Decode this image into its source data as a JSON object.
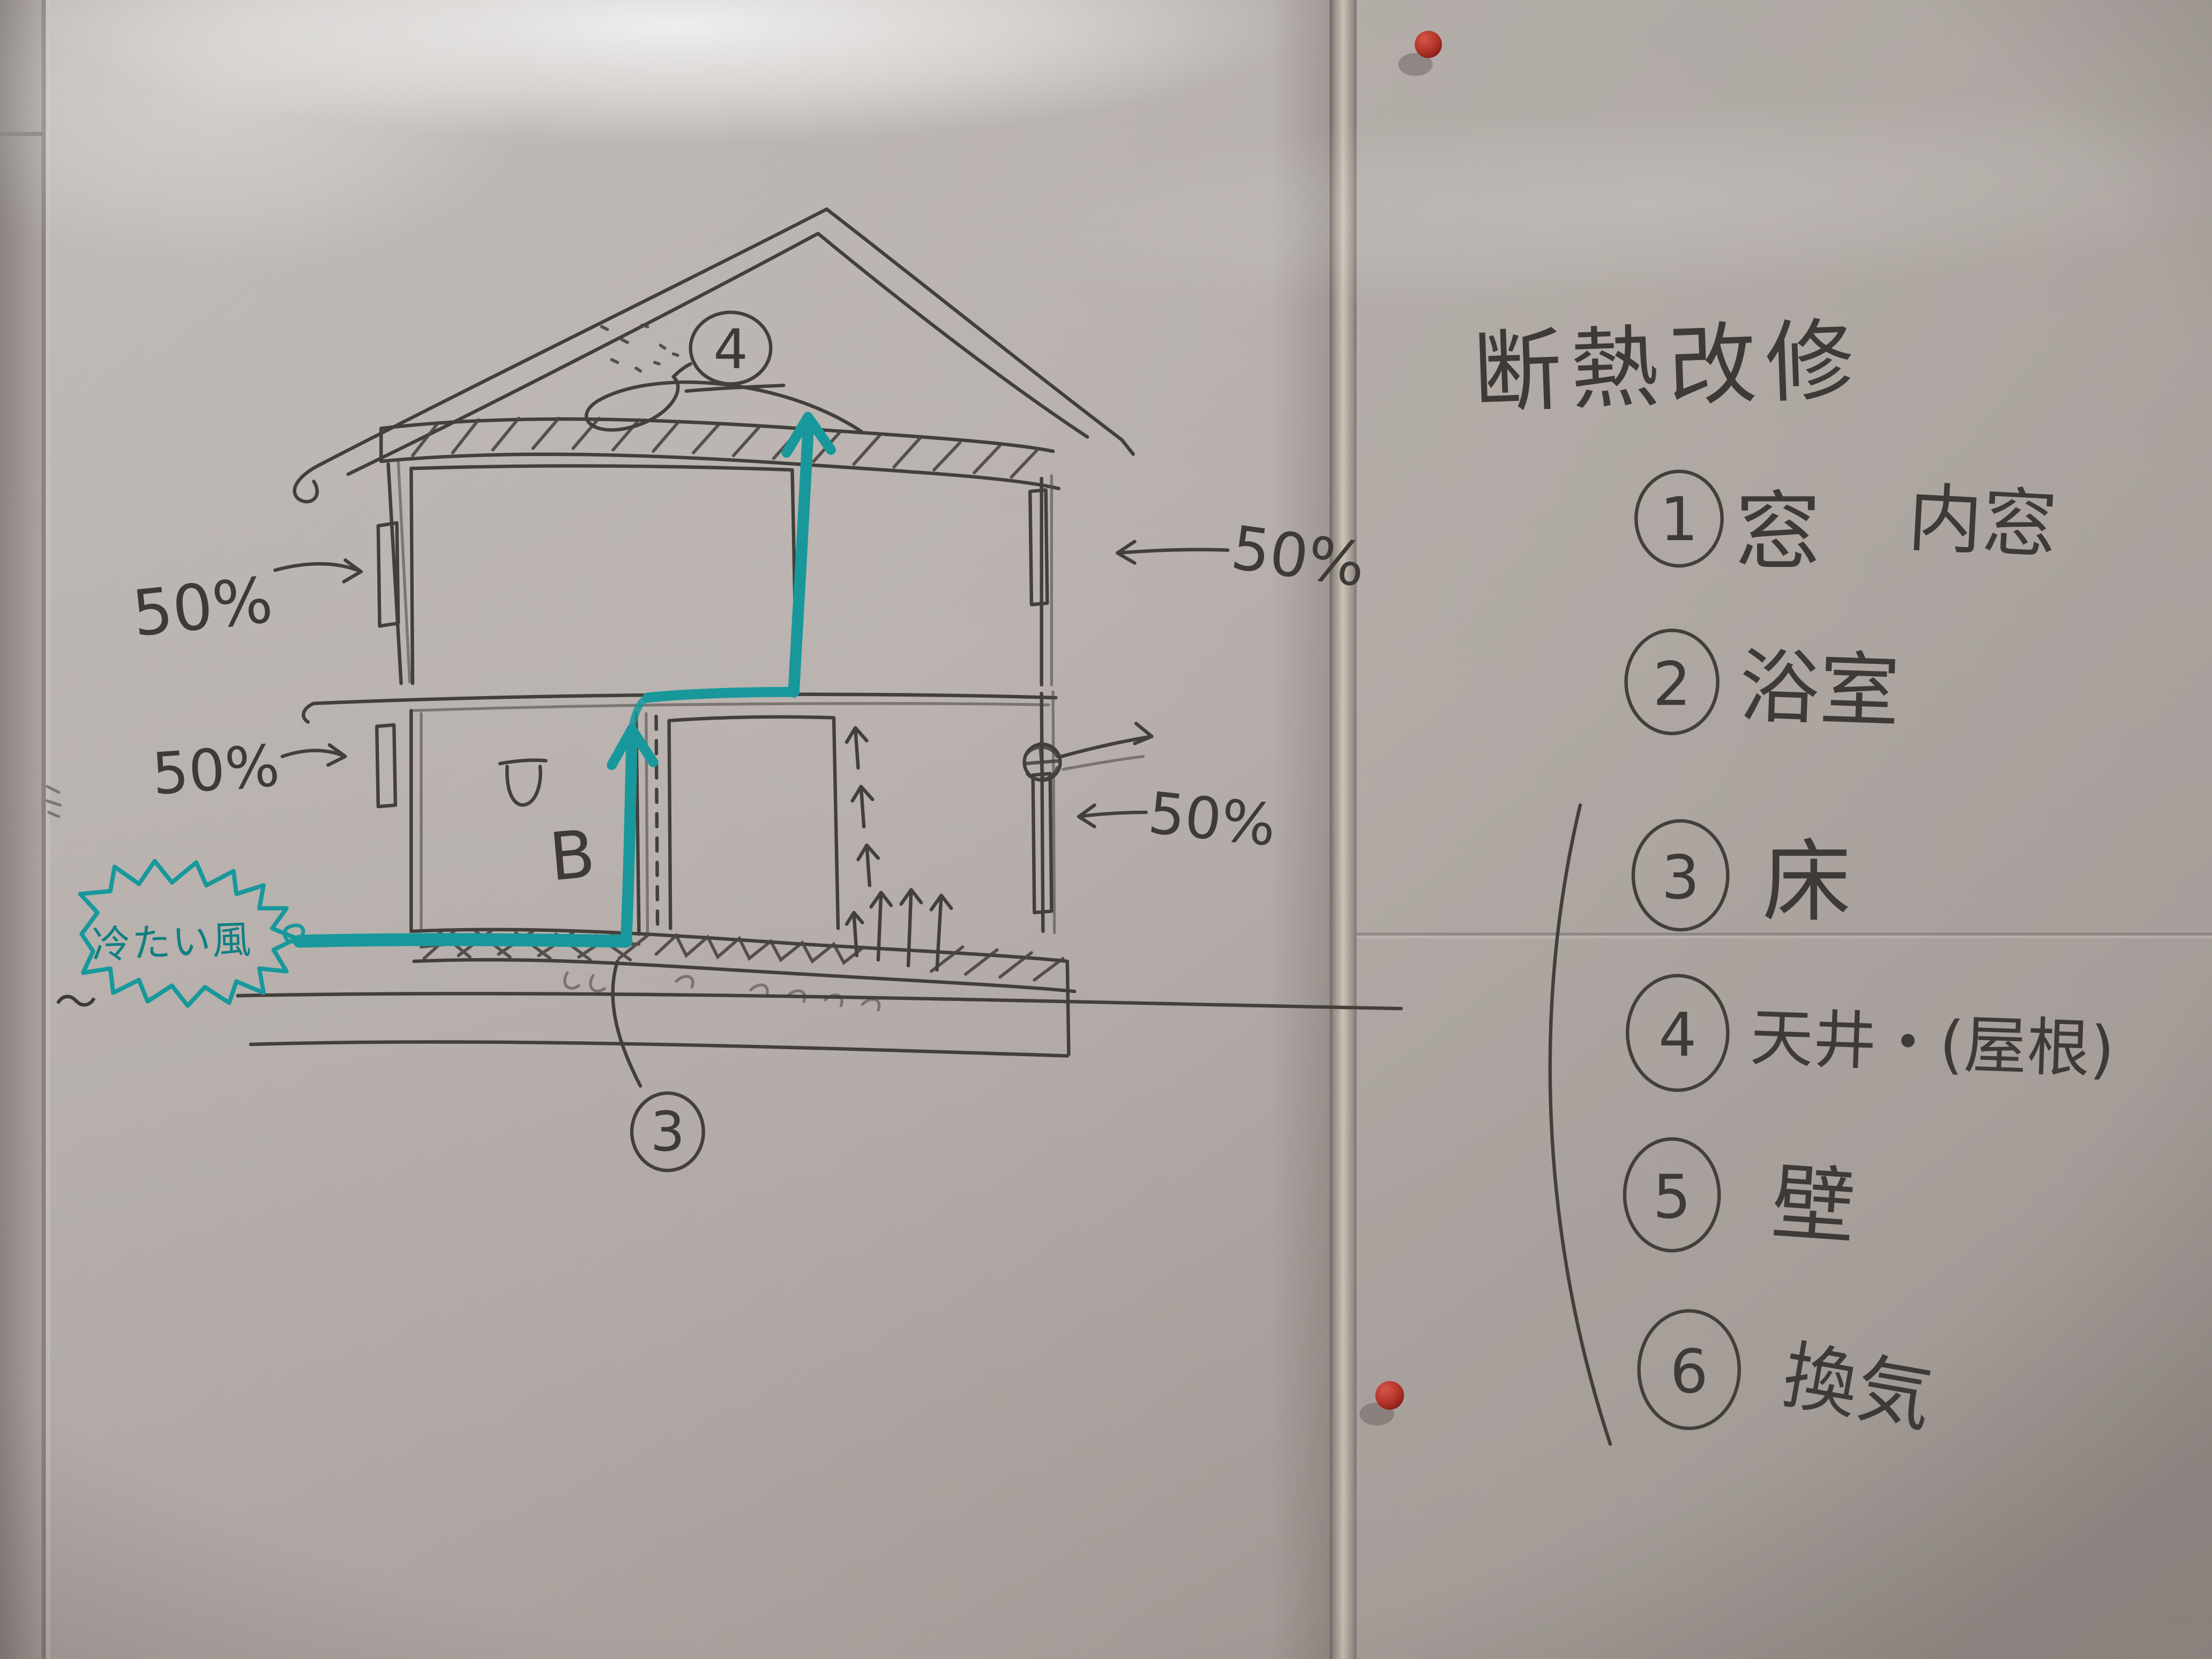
{
  "wb": {
    "title": "断熱改修",
    "items": [
      {
        "num": "1",
        "label": "窓",
        "extra": "内窓"
      },
      {
        "num": "2",
        "label": "浴室",
        "extra": ""
      },
      {
        "num": "3",
        "label": "床",
        "extra": ""
      },
      {
        "num": "4",
        "label": "天井・(屋根)",
        "extra": ""
      },
      {
        "num": "5",
        "label": "壁",
        "extra": ""
      },
      {
        "num": "6",
        "label": "換気",
        "extra": ""
      }
    ]
  },
  "diagram": {
    "cold_wind": "冷たい風",
    "b_label": "B",
    "attic_num": "4",
    "floor_num": "3",
    "pct_top_left": "50%",
    "pct_mid_left": "50%",
    "pct_top_right": "50%",
    "pct_mid_right": "50%",
    "squiggle": "〜"
  },
  "colors": {
    "marker_black": "#433f3b",
    "marker_teal": "#18989b",
    "pin_red": "#b23228",
    "board": "#bdb6b2"
  }
}
